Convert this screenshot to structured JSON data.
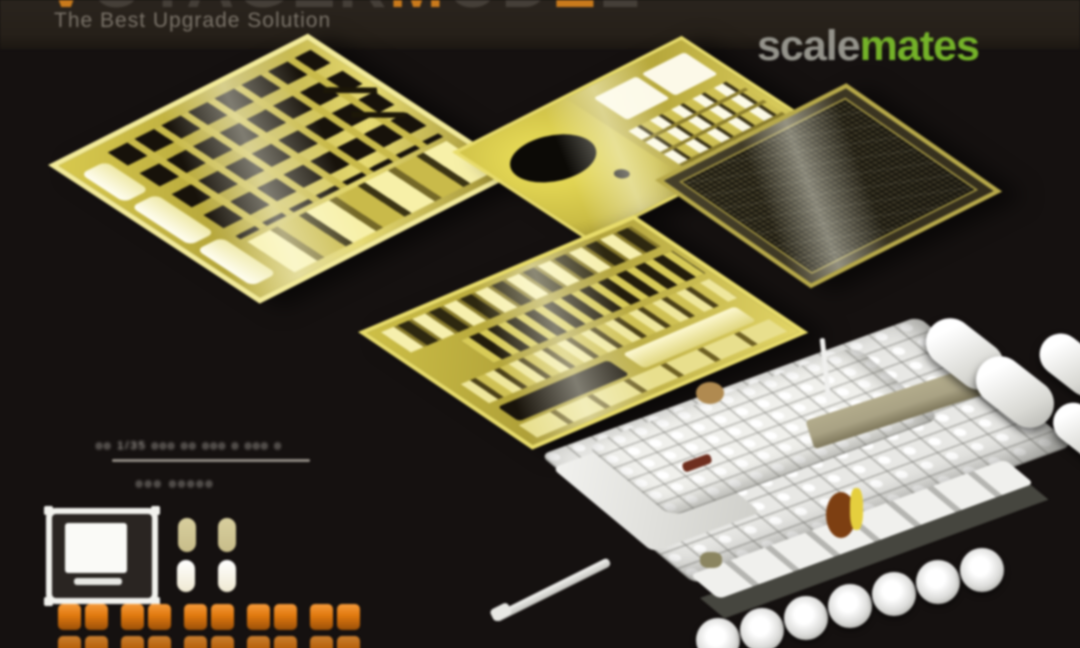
{
  "header": {
    "brand_segments": [
      {
        "text": "V",
        "accent": true
      },
      {
        "text": "OYAGER",
        "accent": false
      },
      {
        "text": "M",
        "accent": true
      },
      {
        "text": "OD",
        "accent": false
      },
      {
        "text": "E",
        "accent": true
      },
      {
        "text": "L",
        "accent": false
      }
    ],
    "tagline": "The Best Upgrade Solution"
  },
  "watermark": {
    "scale": "scale",
    "mates": "mates"
  },
  "legend": {
    "spec_line": "oo 1/35 ooo oo ooo o ooo o",
    "code_line": "ooo ooooo",
    "block_rows": 2,
    "block_groups": 5,
    "blocks_per_group": 2
  },
  "colors": {
    "bg": "#151110",
    "header_bg": "#262019",
    "brand_dim": "#453f38",
    "brand_accent": "#c97a1c",
    "tagline": "#7a7369",
    "wm_scale": "#94938b",
    "wm_mates": "#74b229",
    "brass": "#d2c34c",
    "brass_bright": "#f3eb9a",
    "brass_dark": "#8d7f2d",
    "slot_dark": "#17120a",
    "mesh": "#3a3524",
    "tank_white": "#e8e8e5",
    "tank_shade": "#b9b9b4",
    "deck_tan": "#a9a284",
    "orange": "#e0790f",
    "capsule_cream": "#efe9d2",
    "capsule_gold": "#c8bd8a",
    "legend_text": "#d8d3cb",
    "divider": "#8d8780"
  }
}
